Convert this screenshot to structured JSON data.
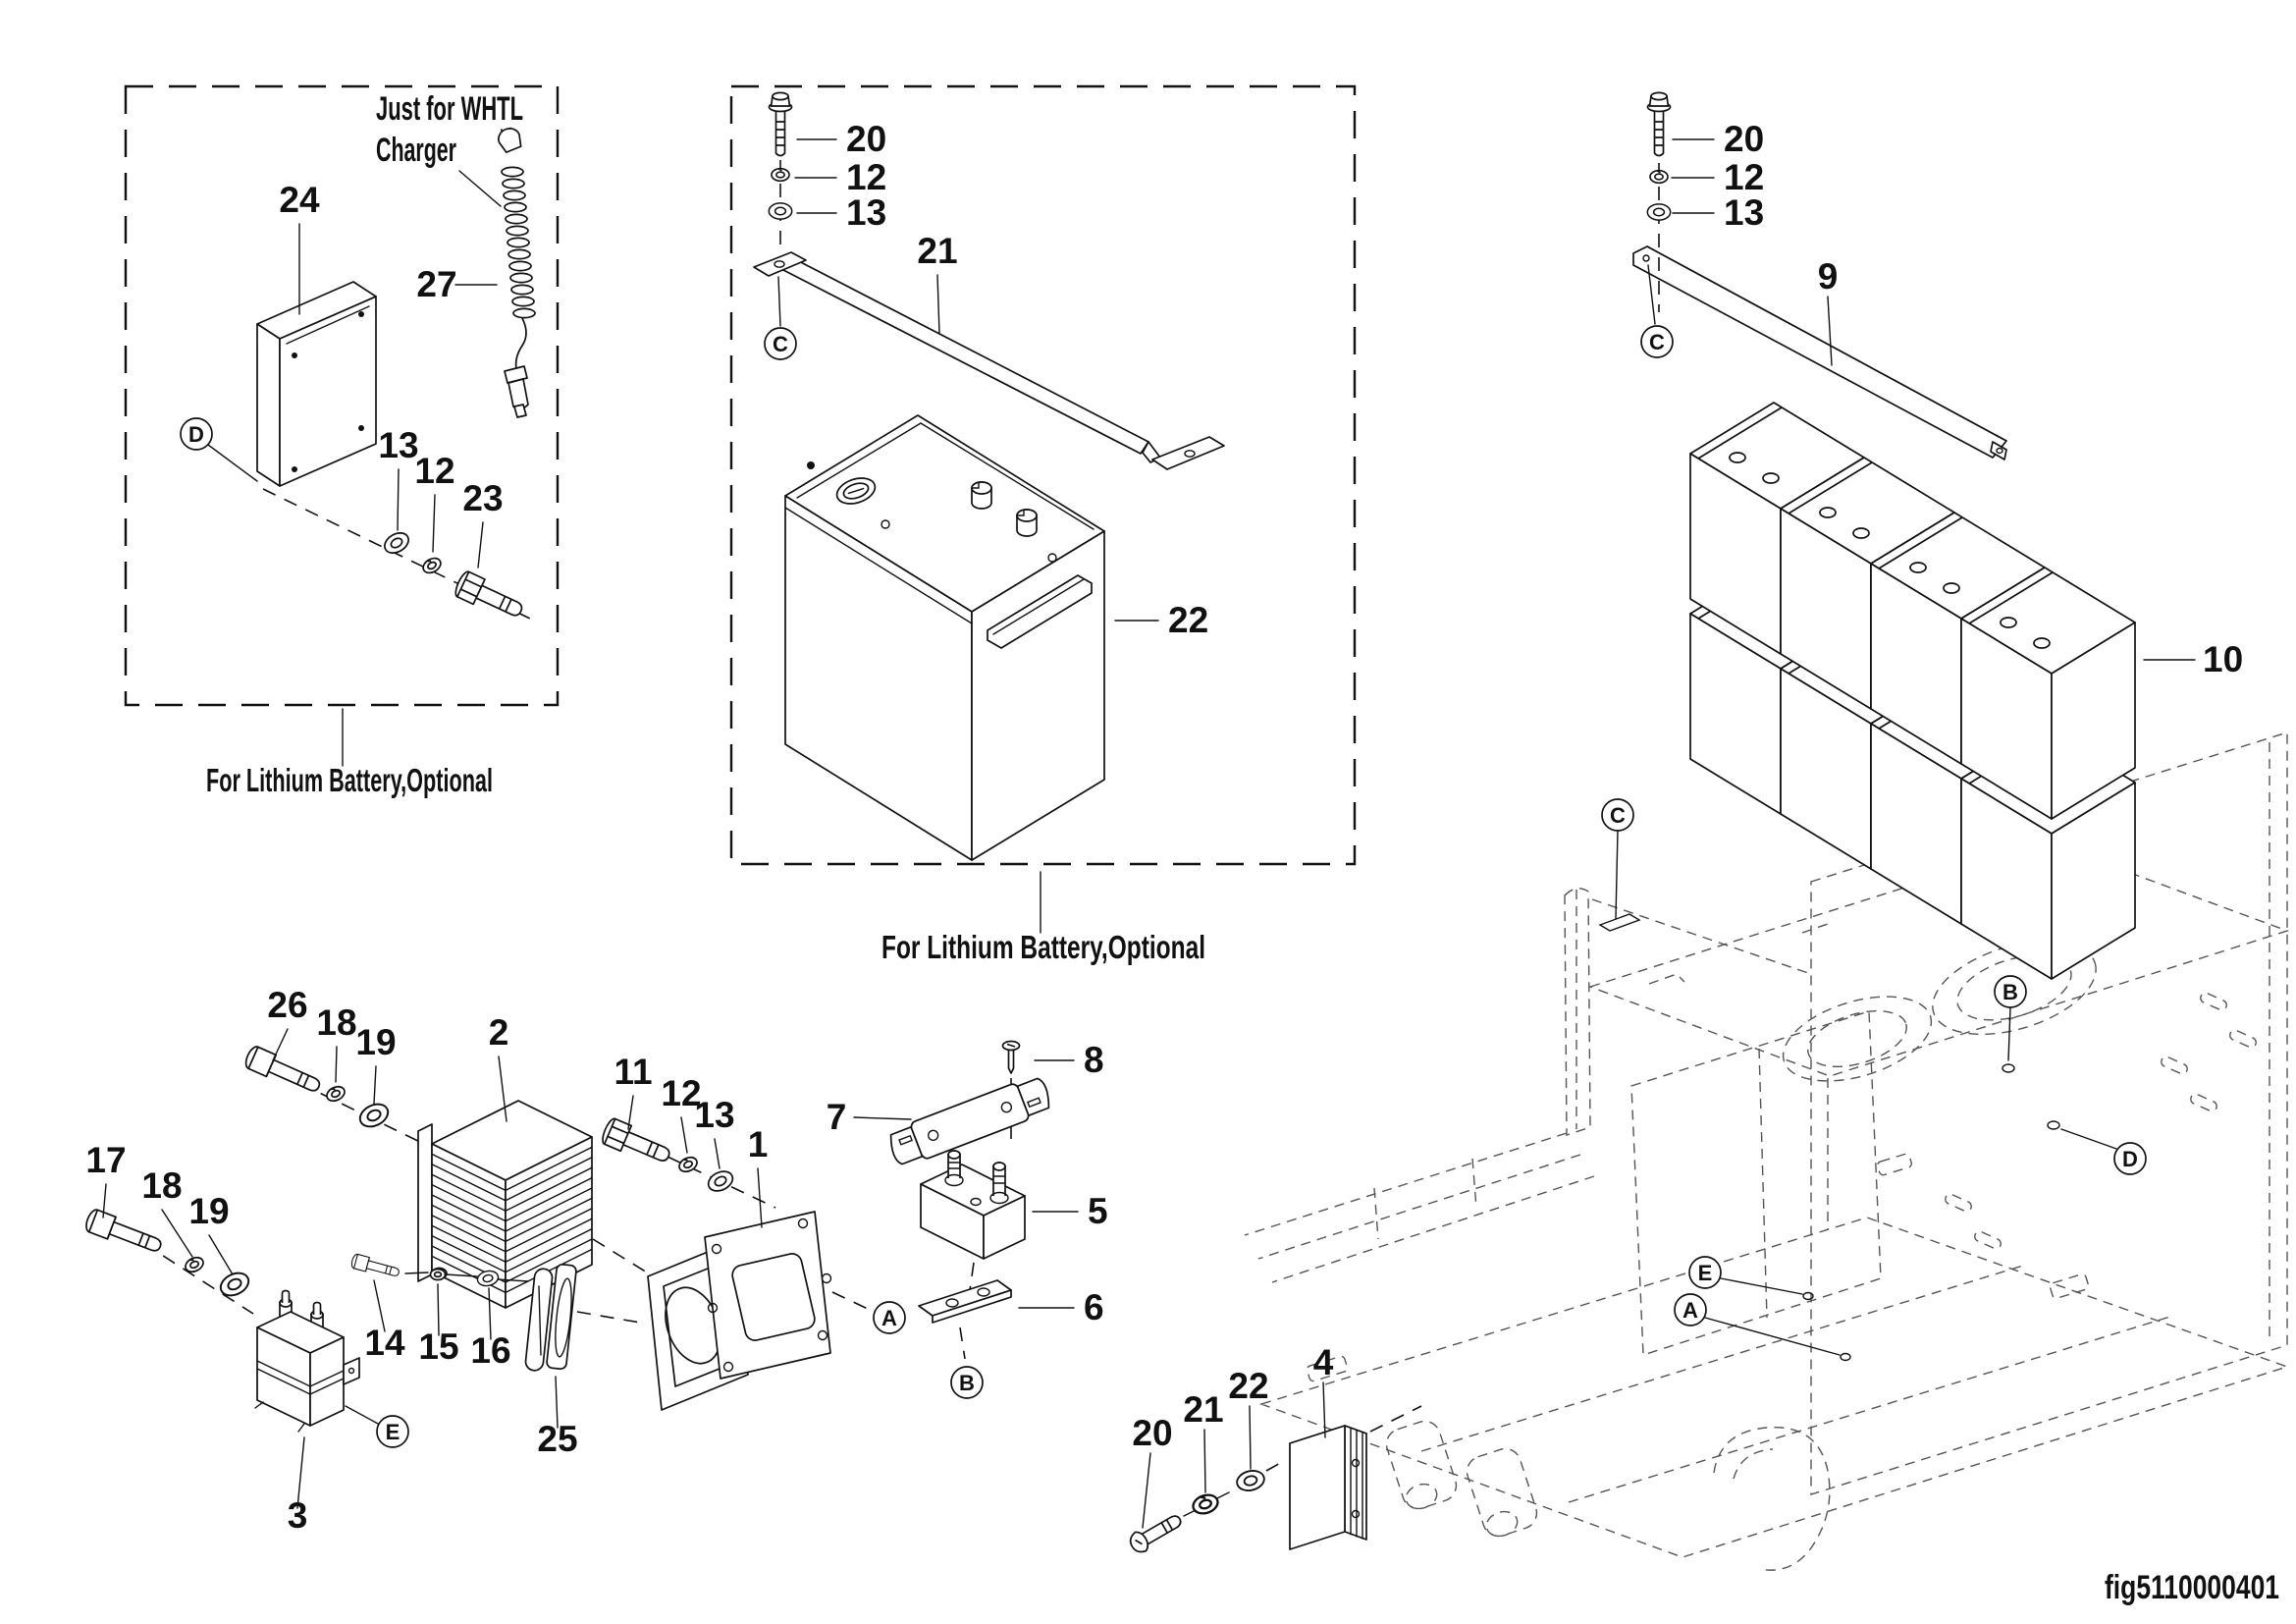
{
  "figure_code": "fig5110000401",
  "whtl_box": {
    "note_line1": "Just for WHTL",
    "note_line2": "Charger",
    "caption": "For Lithium Battery,Optional",
    "callout": "D",
    "labels": {
      "box": "24",
      "cable": "27",
      "washer_spring": "13",
      "washer_lock": "12",
      "bolt": "23"
    }
  },
  "lithium_box": {
    "caption": "For Lithium Battery,Optional",
    "callout": "C",
    "labels": {
      "bolt": "20",
      "washer_lock": "12",
      "washer_flat": "13",
      "strap": "21",
      "battery": "22"
    }
  },
  "battery_bank": {
    "callout": "C",
    "labels": {
      "bolt": "20",
      "washer_lock": "12",
      "washer_flat": "13",
      "rail": "9",
      "batteries": "10"
    }
  },
  "controller_group": {
    "callout_a": "A",
    "labels": {
      "bolt_a": "26",
      "washer_a": "18",
      "washer_b": "19",
      "controller": "2",
      "bolt_b": "11",
      "washer_c": "12",
      "washer_d": "13",
      "bracket": "1"
    }
  },
  "contactor_group": {
    "callout_e": "E",
    "labels": {
      "bolt": "17",
      "washer_a": "18",
      "washer_b": "19",
      "contactor": "3",
      "bolt_small": "14",
      "nut": "15",
      "washer_small": "16",
      "fan": "25"
    }
  },
  "fuse_group": {
    "callout": "B",
    "labels": {
      "fuse": "7",
      "screw": "8",
      "holder": "5",
      "plate": "6"
    }
  },
  "resistor_group": {
    "labels": {
      "screw": "20",
      "washer_spring": "21",
      "washer_flat": "22",
      "module": "4"
    }
  },
  "chassis": {
    "callouts": {
      "c": "C",
      "b": "B",
      "d": "D",
      "e": "E",
      "a": "A"
    }
  }
}
